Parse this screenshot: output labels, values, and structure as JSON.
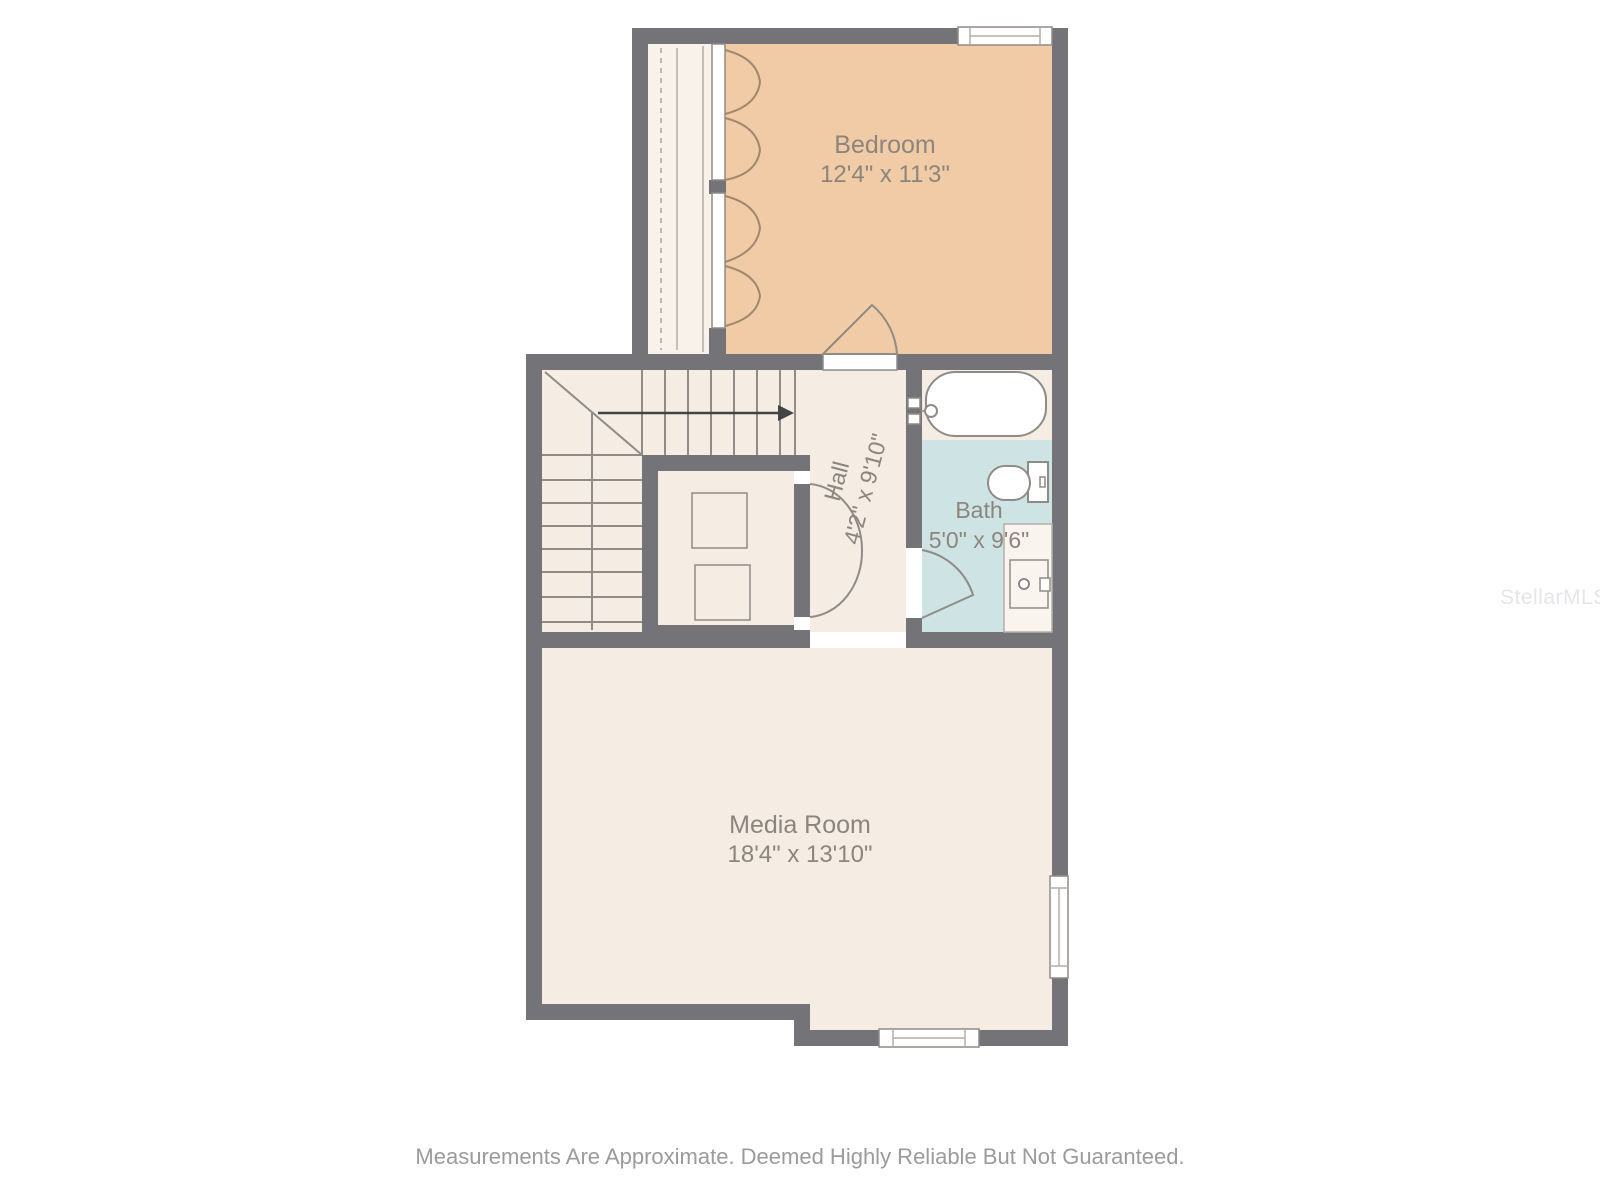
{
  "floorplan": {
    "rooms": {
      "bedroom": {
        "name": "Bedroom",
        "dims": "12'4\" x 11'3\""
      },
      "hall": {
        "name": "Hall",
        "dims": "4'2\" x 9'10\""
      },
      "bath": {
        "name": "Bath",
        "dims": "5'0\" x 9'6\""
      },
      "media_room": {
        "name": "Media Room",
        "dims": "18'4\" x 13'10\""
      }
    },
    "stairs": {
      "direction_arrow": "right"
    },
    "fixtures": [
      "bathtub",
      "toilet",
      "sink-vanity",
      "closet-appliances",
      "bifold-closet-doors"
    ],
    "colors": {
      "wall": "#747478",
      "bedroom_floor": "#f0cba6",
      "floor": "#f5ece4",
      "bath_floor": "#cee3e4",
      "closet_floor": "#f8f2ea",
      "line": "#8f8b86",
      "label_text": "#8c857d",
      "footer_text": "#9b9b9b",
      "arrow": "#434345",
      "watermark_text": "#e6e6ea"
    },
    "footer": "Measurements Are Approximate. Deemed Highly Reliable But Not Guaranteed.",
    "watermark": "StellarMLS"
  }
}
